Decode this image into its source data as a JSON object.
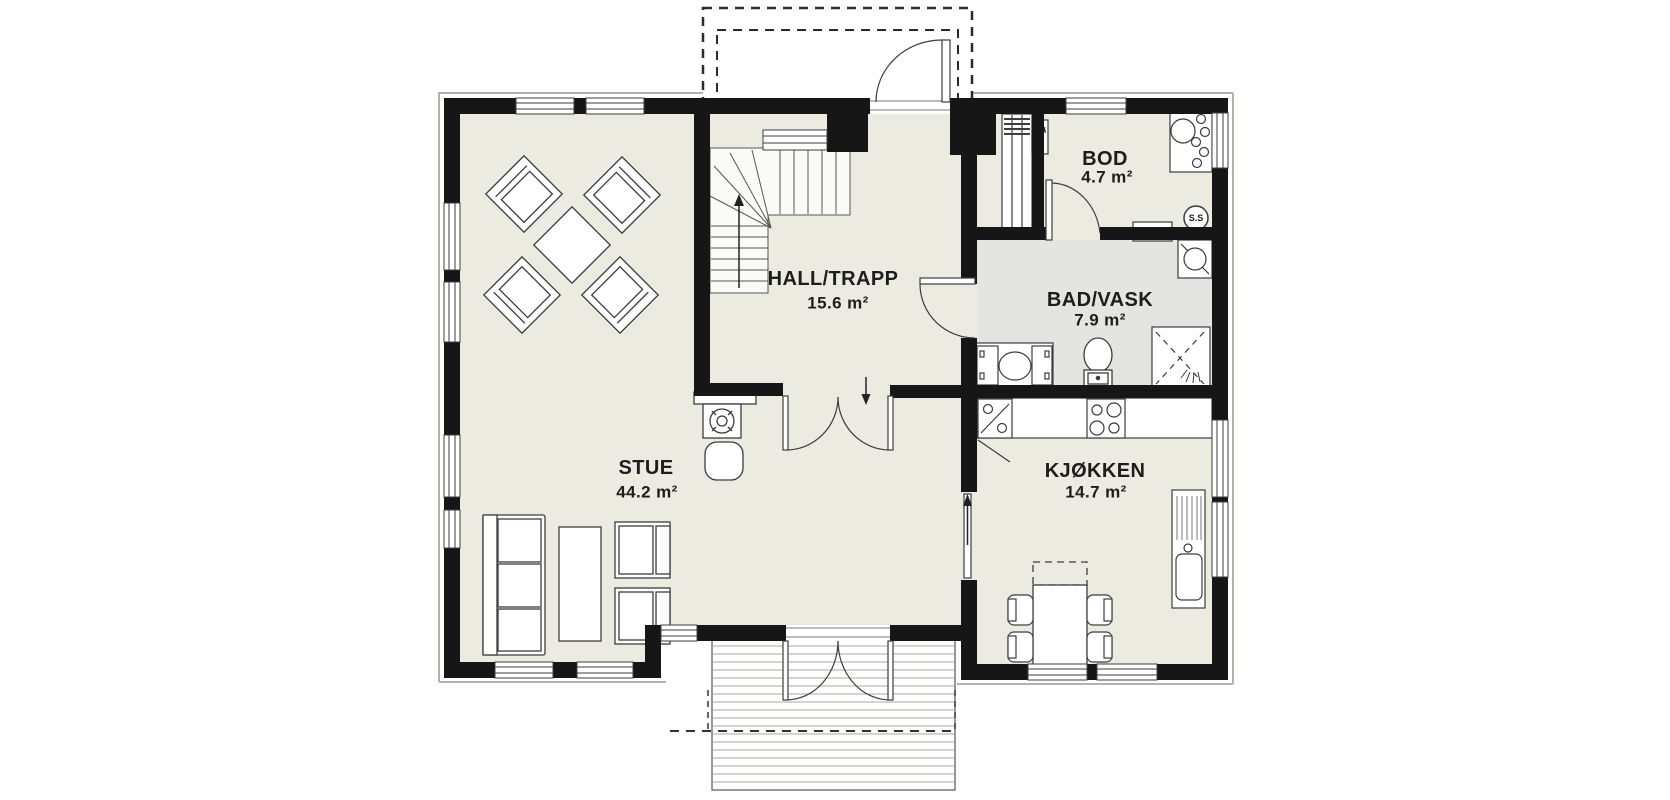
{
  "title": "First floor plan",
  "rooms": [
    {
      "id": "stue",
      "name": "STUE",
      "area": "44.2 m²"
    },
    {
      "id": "hall",
      "name": "HALL/TRAPP",
      "area": "15.6 m²"
    },
    {
      "id": "bod",
      "name": "BOD",
      "area": "4.7 m²"
    },
    {
      "id": "bad",
      "name": "BAD/VASK",
      "area": "7.9 m²"
    },
    {
      "id": "kjokken",
      "name": "KJØKKEN",
      "area": "14.7 m²"
    }
  ],
  "symbols": {
    "central_vacuum": "S.S"
  },
  "fixtures": [
    "stairs",
    "wood-stove",
    "sofa",
    "coffee-table",
    "armchair",
    "lounge-group",
    "dining-table",
    "dining-chair",
    "kitchen-counter",
    "cooktop",
    "kitchen-sink",
    "dishwasher",
    "washbasin-counter",
    "washing-machine",
    "toilet",
    "shower",
    "ventilation-shaft",
    "electrical-panel",
    "central-vacuum-outlet",
    "utility-sink",
    "fan-cabinet",
    "entrance-porch",
    "terrace-deck",
    "entrance-door",
    "terrace-double-door"
  ],
  "colors": {
    "wall": "#161616",
    "floor": "#ECEBE2",
    "wet_room_floor": "#E4E4E2",
    "outline": "#3c3c3c",
    "deck_plank": "#a9a9a3",
    "background": "#ffffff"
  }
}
